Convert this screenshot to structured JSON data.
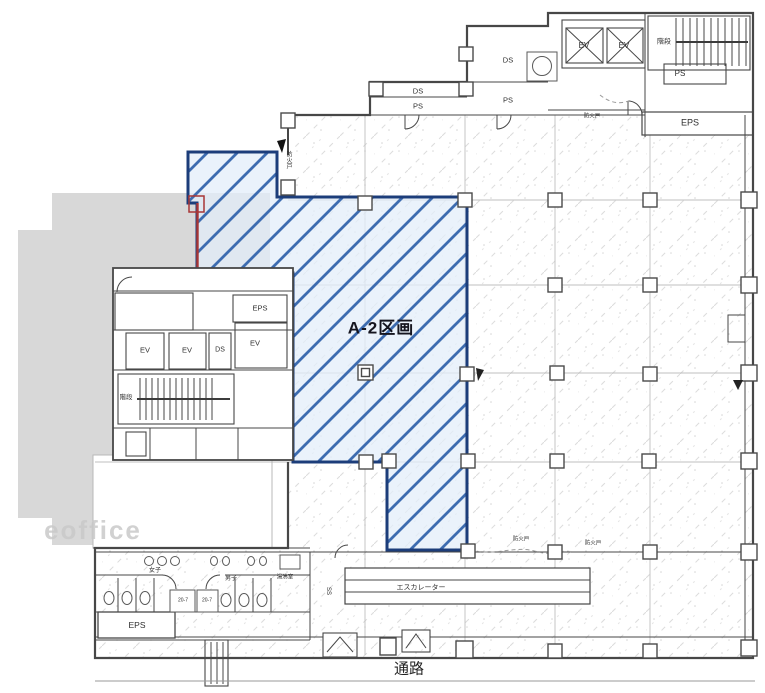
{
  "plan_title": "A-2区画 フロアプラン",
  "labels": {
    "parcel": "A-2区画",
    "passage": "通路",
    "watermark": "eoffice",
    "ev": "EV",
    "eps": "EPS",
    "ps": "PS",
    "ds": "DS",
    "stairs": "階段",
    "fire_door": "防火戸",
    "women": "女子",
    "men": "男子",
    "kitchen": "湯沸室",
    "escalator": "エスカレーター",
    "stall_tag": "20-7",
    "ss": "SS"
  },
  "colors": {
    "wall": "#474747",
    "grid": "#b5b5b5",
    "neighbor_gray": "#d8d8d8",
    "parcel_fill": "#e3edf9",
    "parcel_stripe": "#3d6cb0",
    "parcel_border": "#1c3d7a",
    "red_mark": "#a83636",
    "texture": "#d9d9d9",
    "watermark_gray": "#c9c9c9"
  }
}
